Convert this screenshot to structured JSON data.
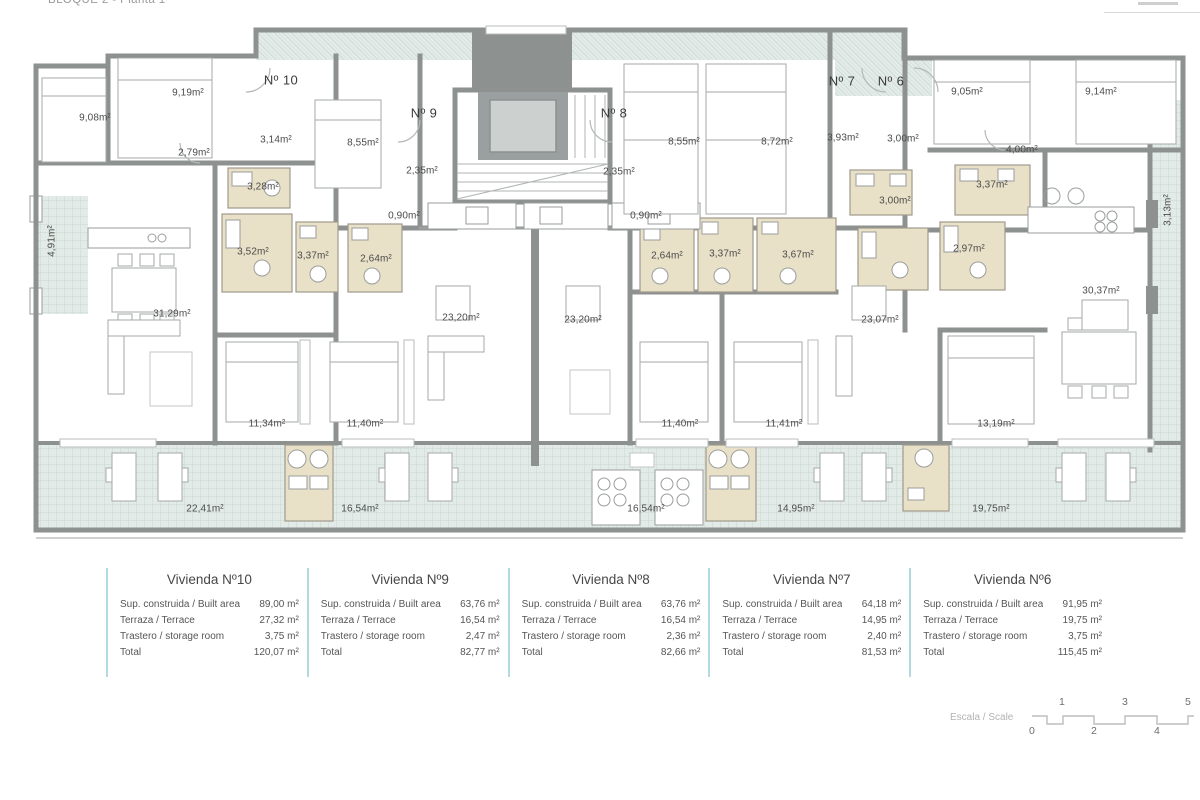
{
  "header": {
    "title": "BLOQUE 2 - Planta 1ª"
  },
  "floor_plan": {
    "unit_labels": [
      {
        "text": "Nº 10",
        "x": 281,
        "y": 80
      },
      {
        "text": "Nº 9",
        "x": 424,
        "y": 113
      },
      {
        "text": "Nº 8",
        "x": 614,
        "y": 113
      },
      {
        "text": "Nº 7",
        "x": 842,
        "y": 81
      },
      {
        "text": "Nº 6",
        "x": 891,
        "y": 81
      }
    ],
    "room_labels": [
      {
        "text": "9,08m²",
        "x": 95,
        "y": 118
      },
      {
        "text": "9,19m²",
        "x": 188,
        "y": 93
      },
      {
        "text": "2,79m²",
        "x": 194,
        "y": 153
      },
      {
        "text": "3,14m²",
        "x": 276,
        "y": 140
      },
      {
        "text": "8,55m²",
        "x": 363,
        "y": 143
      },
      {
        "text": "2,35m²",
        "x": 422,
        "y": 171
      },
      {
        "text": "0,90m²",
        "x": 404,
        "y": 216
      },
      {
        "text": "3,28m²",
        "x": 263,
        "y": 187
      },
      {
        "text": "3,52m²",
        "x": 253,
        "y": 252
      },
      {
        "text": "3,37m²",
        "x": 313,
        "y": 256
      },
      {
        "text": "2,64m²",
        "x": 376,
        "y": 259
      },
      {
        "text": "8,55m²",
        "x": 684,
        "y": 142
      },
      {
        "text": "8,72m²",
        "x": 777,
        "y": 142
      },
      {
        "text": "2,35m²",
        "x": 619,
        "y": 172
      },
      {
        "text": "0,90m²",
        "x": 646,
        "y": 216
      },
      {
        "text": "2,64m²",
        "x": 667,
        "y": 256
      },
      {
        "text": "3,37m²",
        "x": 725,
        "y": 254
      },
      {
        "text": "3,67m²",
        "x": 798,
        "y": 255
      },
      {
        "text": "3,93m²",
        "x": 843,
        "y": 138
      },
      {
        "text": "3,00m²",
        "x": 903,
        "y": 139
      },
      {
        "text": "9,05m²",
        "x": 967,
        "y": 92
      },
      {
        "text": "9,14m²",
        "x": 1101,
        "y": 92
      },
      {
        "text": "4,00m²",
        "x": 1022,
        "y": 150
      },
      {
        "text": "3,00m²",
        "x": 895,
        "y": 201
      },
      {
        "text": "3,37m²",
        "x": 992,
        "y": 185
      },
      {
        "text": "2,97m²",
        "x": 969,
        "y": 249
      },
      {
        "text": "31,29m²",
        "x": 172,
        "y": 314
      },
      {
        "text": "23,20m²",
        "x": 461,
        "y": 318
      },
      {
        "text": "23,20m²",
        "x": 583,
        "y": 320
      },
      {
        "text": "23,07m²",
        "x": 880,
        "y": 320
      },
      {
        "text": "30,37m²",
        "x": 1101,
        "y": 291
      },
      {
        "text": "11,34m²",
        "x": 267,
        "y": 424
      },
      {
        "text": "11,40m²",
        "x": 365,
        "y": 424
      },
      {
        "text": "11,40m²",
        "x": 680,
        "y": 424
      },
      {
        "text": "11,41m²",
        "x": 784,
        "y": 424
      },
      {
        "text": "13,19m²",
        "x": 996,
        "y": 424
      },
      {
        "text": "22,41m²",
        "x": 205,
        "y": 509
      },
      {
        "text": "16,54m²",
        "x": 360,
        "y": 509
      },
      {
        "text": "16,54m²",
        "x": 646,
        "y": 509
      },
      {
        "text": "14,95m²",
        "x": 796,
        "y": 509
      },
      {
        "text": "19,75m²",
        "x": 991,
        "y": 509
      },
      {
        "text": "4,91m²",
        "x": 52,
        "y": 241,
        "cls": "vert"
      },
      {
        "text": "3,13m²",
        "x": 1168,
        "y": 210,
        "cls": "vert"
      }
    ]
  },
  "legend": {
    "columns": [
      {
        "title": "Vivienda Nº10",
        "rows": [
          {
            "label": "Sup. construida / Built area",
            "value": "89,00 m²"
          },
          {
            "label": "Terraza / Terrace",
            "value": "27,32 m²"
          },
          {
            "label": "Trastero / storage room",
            "value": "3,75 m²"
          },
          {
            "label": "Total",
            "value": "120,07 m²"
          }
        ]
      },
      {
        "title": "Vivienda Nº9",
        "rows": [
          {
            "label": "Sup. construida / Built area",
            "value": "63,76 m²"
          },
          {
            "label": "Terraza / Terrace",
            "value": "16,54 m²"
          },
          {
            "label": "Trastero / storage room",
            "value": "2,47 m²"
          },
          {
            "label": "Total",
            "value": "82,77 m²"
          }
        ]
      },
      {
        "title": "Vivienda Nº8",
        "rows": [
          {
            "label": "Sup. construida / Built area",
            "value": "63,76 m²"
          },
          {
            "label": "Terraza / Terrace",
            "value": "16,54 m²"
          },
          {
            "label": "Trastero / storage room",
            "value": "2,36 m²"
          },
          {
            "label": "Total",
            "value": "82,66 m²"
          }
        ]
      },
      {
        "title": "Vivienda Nº7",
        "rows": [
          {
            "label": "Sup. construida / Built area",
            "value": "64,18 m²"
          },
          {
            "label": "Terraza / Terrace",
            "value": "14,95 m²"
          },
          {
            "label": "Trastero / storage room",
            "value": "2,40 m²"
          },
          {
            "label": "Total",
            "value": "81,53 m²"
          }
        ]
      },
      {
        "title": "Vivienda Nº6",
        "rows": [
          {
            "label": "Sup. construida / Built area",
            "value": "91,95 m²"
          },
          {
            "label": "Terraza / Terrace",
            "value": "19,75 m²"
          },
          {
            "label": "Trastero / storage room",
            "value": "3,75 m²"
          },
          {
            "label": "Total",
            "value": "115,45 m²"
          }
        ]
      }
    ]
  },
  "scale": {
    "label": "Escala / Scale",
    "marks": [
      {
        "text": "0",
        "x": 1032,
        "y": 731
      },
      {
        "text": "1",
        "x": 1062,
        "y": 702
      },
      {
        "text": "2",
        "x": 1094,
        "y": 731
      },
      {
        "text": "3",
        "x": 1125,
        "y": 702
      },
      {
        "text": "4",
        "x": 1157,
        "y": 731
      },
      {
        "text": "5",
        "x": 1188,
        "y": 702
      }
    ]
  }
}
